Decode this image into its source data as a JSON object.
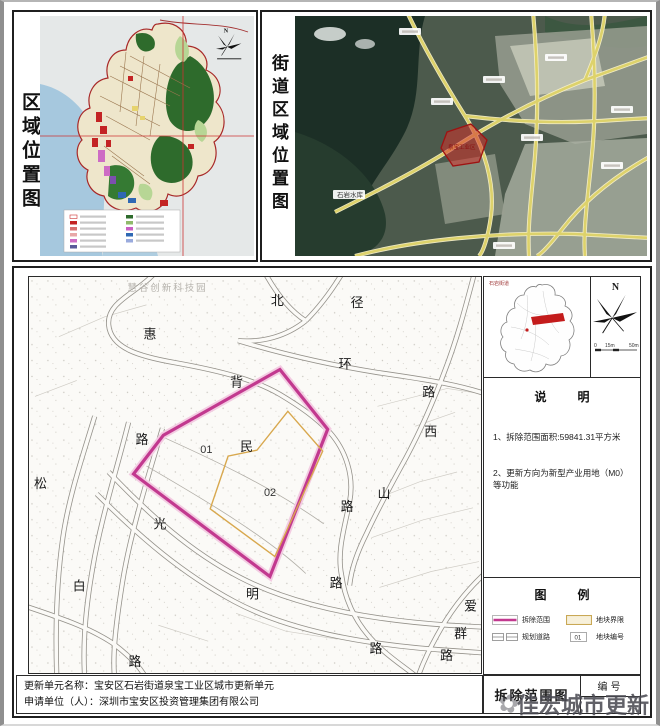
{
  "page": {
    "region_panel": {
      "title": "区域位置图"
    },
    "street_panel": {
      "title": "街道区域位置图",
      "map_labels": {
        "reservoir": "石岩水库",
        "site": "泉宝工业区"
      }
    },
    "site_plan": {
      "ghost_label": "慧谷创新科技园",
      "parcel_ids": [
        {
          "id": "01"
        },
        {
          "id": "02"
        }
      ],
      "road_labels": [
        {
          "t": "北"
        },
        {
          "t": "径"
        },
        {
          "t": "惠"
        },
        {
          "t": "环"
        },
        {
          "t": "背"
        },
        {
          "t": "路"
        },
        {
          "t": "路"
        },
        {
          "t": "民"
        },
        {
          "t": "西"
        },
        {
          "t": "山"
        },
        {
          "t": "路"
        },
        {
          "t": "松"
        },
        {
          "t": "光"
        },
        {
          "t": "白"
        },
        {
          "t": "明"
        },
        {
          "t": "路"
        },
        {
          "t": "爱"
        },
        {
          "t": "群"
        },
        {
          "t": "路"
        },
        {
          "t": "路"
        },
        {
          "t": "路"
        }
      ],
      "inset": {
        "area_label": "石岩街道"
      },
      "compass": {
        "north": "N",
        "scale_ticks": [
          {
            "t": "0"
          },
          {
            "t": "15m"
          },
          {
            "t": "50m"
          }
        ]
      }
    },
    "notes": {
      "title": "说  明",
      "item1": "1、拆除范围面积:59841.31平方米",
      "item2": "2、更新方向为新型产业用地（M0）等功能"
    },
    "legend": {
      "title": "图  例",
      "items": [
        {
          "label": "拆除范围"
        },
        {
          "label": "地块界限"
        },
        {
          "label": "规划道路"
        },
        {
          "label": "地块编号",
          "swatch_text": "01"
        }
      ]
    },
    "titleblock": {
      "drawing_title": "拆除范围图",
      "number_label": "编号"
    },
    "footer": {
      "line1_label": "更新单元名称：",
      "line1_value": "宝安区石岩街道泉宝工业区城市更新单元",
      "line2_label": "申请单位（人）：",
      "line2_value": "深圳市宝安区投资管理集团有限公司"
    },
    "watermark": "佳宏城市更新",
    "colors": {
      "demolition": "#c2398f",
      "parcel_boundary": "#d8a84e",
      "highlight_red": "#cc2222",
      "road_yellow": "#ddd26b"
    }
  }
}
